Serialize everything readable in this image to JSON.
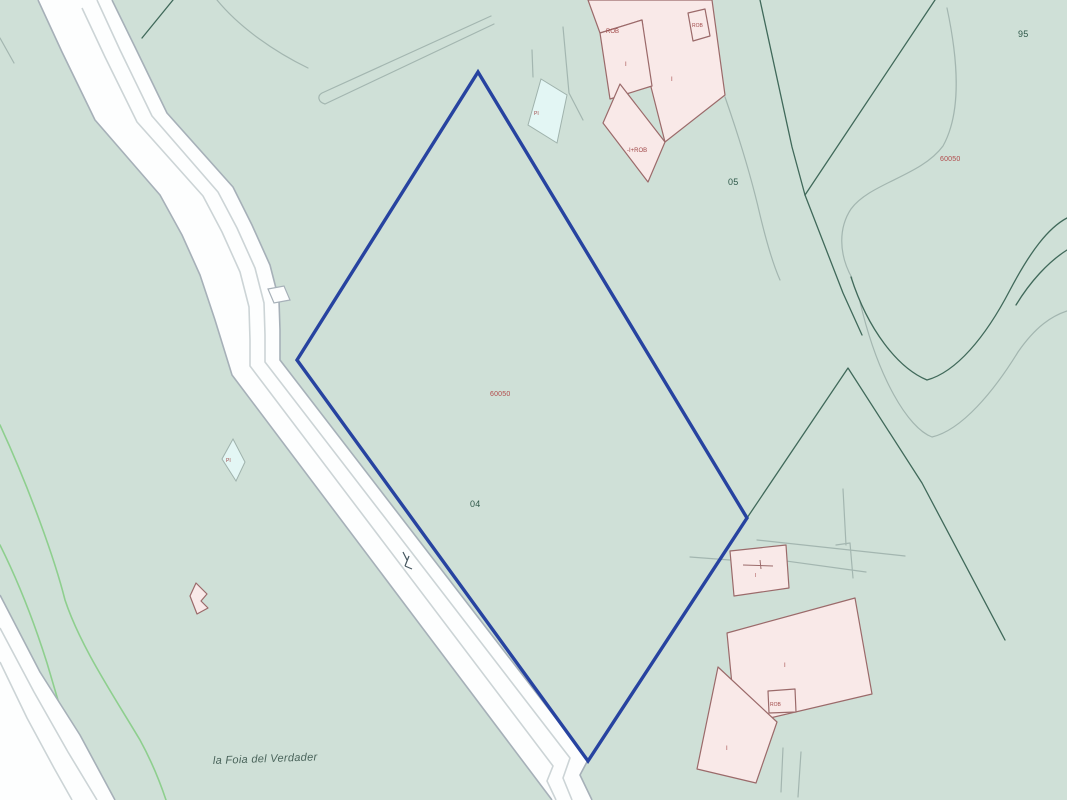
{
  "map": {
    "toponym": "la Foia del Verdader",
    "parcel_numbers": {
      "selected_parcel": "04",
      "upper_right": "05",
      "far_upper_right": "95"
    },
    "parcel_refs": {
      "selected_parcel_ref": "60050",
      "upper_right_ref": "60050"
    },
    "building_labels": {
      "rob": "ROB",
      "floors_one": "I",
      "basement_rob": "-I+ROB",
      "pool": "PI"
    },
    "colors": {
      "background": "#cfe0d7",
      "road_fill": "#fdfefe",
      "road_casing": "#a6b0b8",
      "building_fill": "#f9e9e8",
      "building_stroke": "#9b6a6a",
      "selected_parcel_outline": "#2743a0",
      "boundary_green_dark": "#40695a",
      "boundary_green_light": "#8ecf8e",
      "boundary_gray": "#a3b6b0",
      "label_green": "#2d5748",
      "label_red": "#b14a4a",
      "pool_fill": "#e3f6f4"
    }
  }
}
